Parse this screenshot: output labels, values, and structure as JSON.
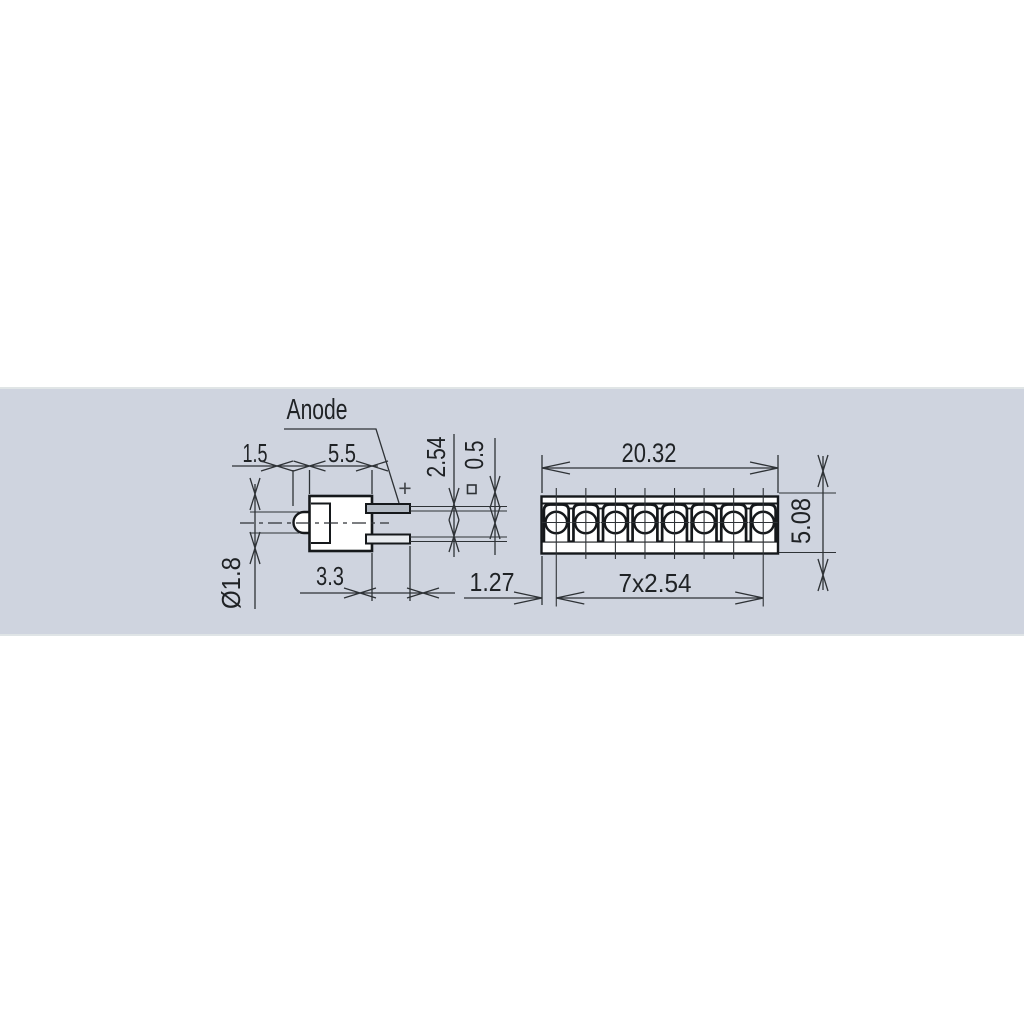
{
  "drawing": {
    "description": "LED array technical dimension drawing, two orthographic views",
    "side_view": {
      "anode_label": "Anode",
      "polarity_symbol": "+",
      "square_section_symbol": "square-pin-cross-section-icon",
      "dims": {
        "lens_protrusion": "1.5",
        "body_depth": "5.5",
        "pin_pitch": "2.54",
        "pin_thickness": "0.5",
        "lens_diameter": "Ø1.8",
        "pin_length": "3.3"
      }
    },
    "front_view": {
      "led_count": 8,
      "dims": {
        "overall_width": "20.32",
        "overall_height": "5.08",
        "pin_span": "7x2.54",
        "edge_offset": "1.27"
      }
    },
    "colors": {
      "band_background": "#cfd4df",
      "line": "#2e3236",
      "outline": "#15181b",
      "text": "#1f2225",
      "anode_pin_fill": "#b3bac4",
      "other_pin_fill": "#e9ecf0"
    }
  }
}
